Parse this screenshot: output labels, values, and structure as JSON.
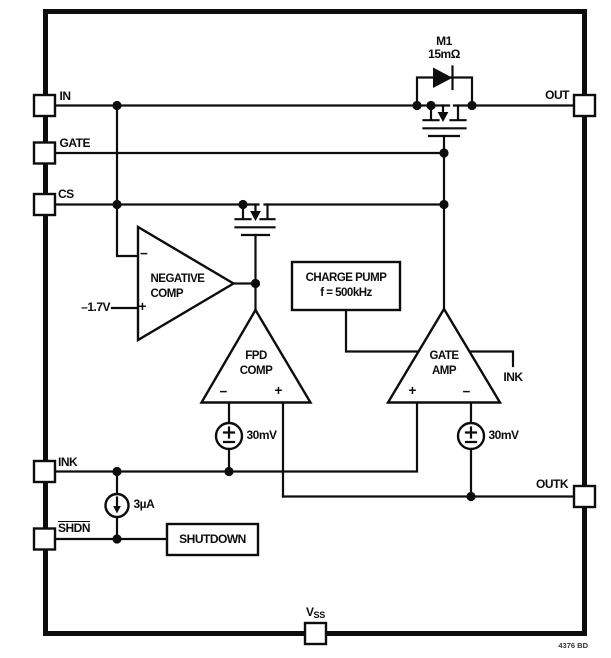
{
  "pins": {
    "in": "IN",
    "gate": "GATE",
    "cs": "CS",
    "ink": "INK",
    "shdn": "SHDN",
    "out": "OUT",
    "outk": "OUTK",
    "vss_letter": "V",
    "vss_sub": "SS"
  },
  "mosfet_m1": {
    "designator": "M1",
    "on_resistance": "15mΩ"
  },
  "negative_comp": {
    "name_line1": "NEGATIVE",
    "name_line2": "COMP",
    "reference": "–1.7V"
  },
  "fpd_comp": {
    "name_line1": "FPD",
    "name_line2": "COMP"
  },
  "gate_amp": {
    "name_line1": "GATE",
    "name_line2": "AMP",
    "ink_net": "INK"
  },
  "charge_pump": {
    "name": "CHARGE PUMP",
    "frequency": "f = 500kHz"
  },
  "shutdown_block": {
    "label": "SHUTDOWN"
  },
  "offset_source_left": {
    "value": "30mV"
  },
  "offset_source_right": {
    "value": "30mV"
  },
  "current_source": {
    "value": "3µA"
  },
  "signs": {
    "plus": "+",
    "minus": "−"
  },
  "footer": {
    "code": "4376 BD"
  },
  "colors": {
    "ink": "#0d0d0d",
    "background": "#ffffff"
  }
}
